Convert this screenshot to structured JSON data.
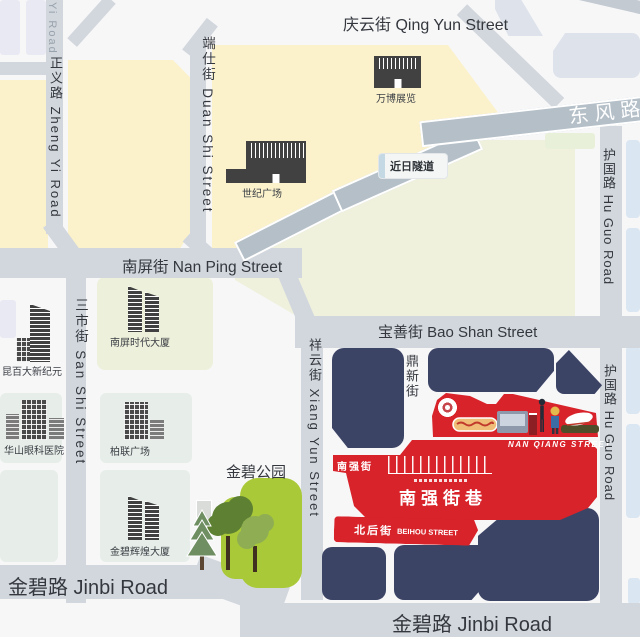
{
  "streets": {
    "yi_road": "Yi Road",
    "zhengyi": "正义路 Zheng Yi Road",
    "duanshi": "端仕街 Duan Shi Street",
    "qingyun": "庆云街 Qing Yun Street",
    "dongfeng": "东风路",
    "jinri_tunnel": "近日隧道",
    "huguo_upper": "护国路 Hu Guo Road",
    "huguo_lower": "护国路 Hu Guo Road",
    "nanping": "南屏街  Nan Ping Street",
    "sanshi": "三市街 San Shi Street",
    "baoshan": "宝善街  Bao Shan Street",
    "xiangyun": "祥云街 Xiang Yun Street",
    "dingxin": "鼎新街",
    "jinbi_left": "金碧路  Jinbi Road",
    "jinbi_right": "金碧路  Jinbi Road"
  },
  "places": {
    "wanbo": "万博展览",
    "shiji": "世纪广场",
    "nanping_tower": "南屏时代大厦",
    "kunbaida": "昆百大新纪元",
    "huashan": "华山眼科医院",
    "bolian": "柏联广场",
    "jinbi_tower": "金碧辉煌大厦",
    "jinbi_park": "金碧公园"
  },
  "highlight": {
    "badge": "南强街",
    "street_en": "NAN QIANG STREET",
    "title": "南强街巷",
    "beihou_cn": "北后街",
    "beihou_en": "BEIHOU STREET"
  },
  "colors": {
    "red": "#d8232b",
    "navy": "#3c4466",
    "road": "#d2d7dd",
    "road_dark": "#b4bfc8",
    "yellow_block": "#fbf2cc",
    "olive_block": "#eff1dd",
    "green_block": "#e7eee9",
    "park_green": "#aac938",
    "lavender_block": "#e9e9f3",
    "blue_block": "#dae6f2"
  }
}
